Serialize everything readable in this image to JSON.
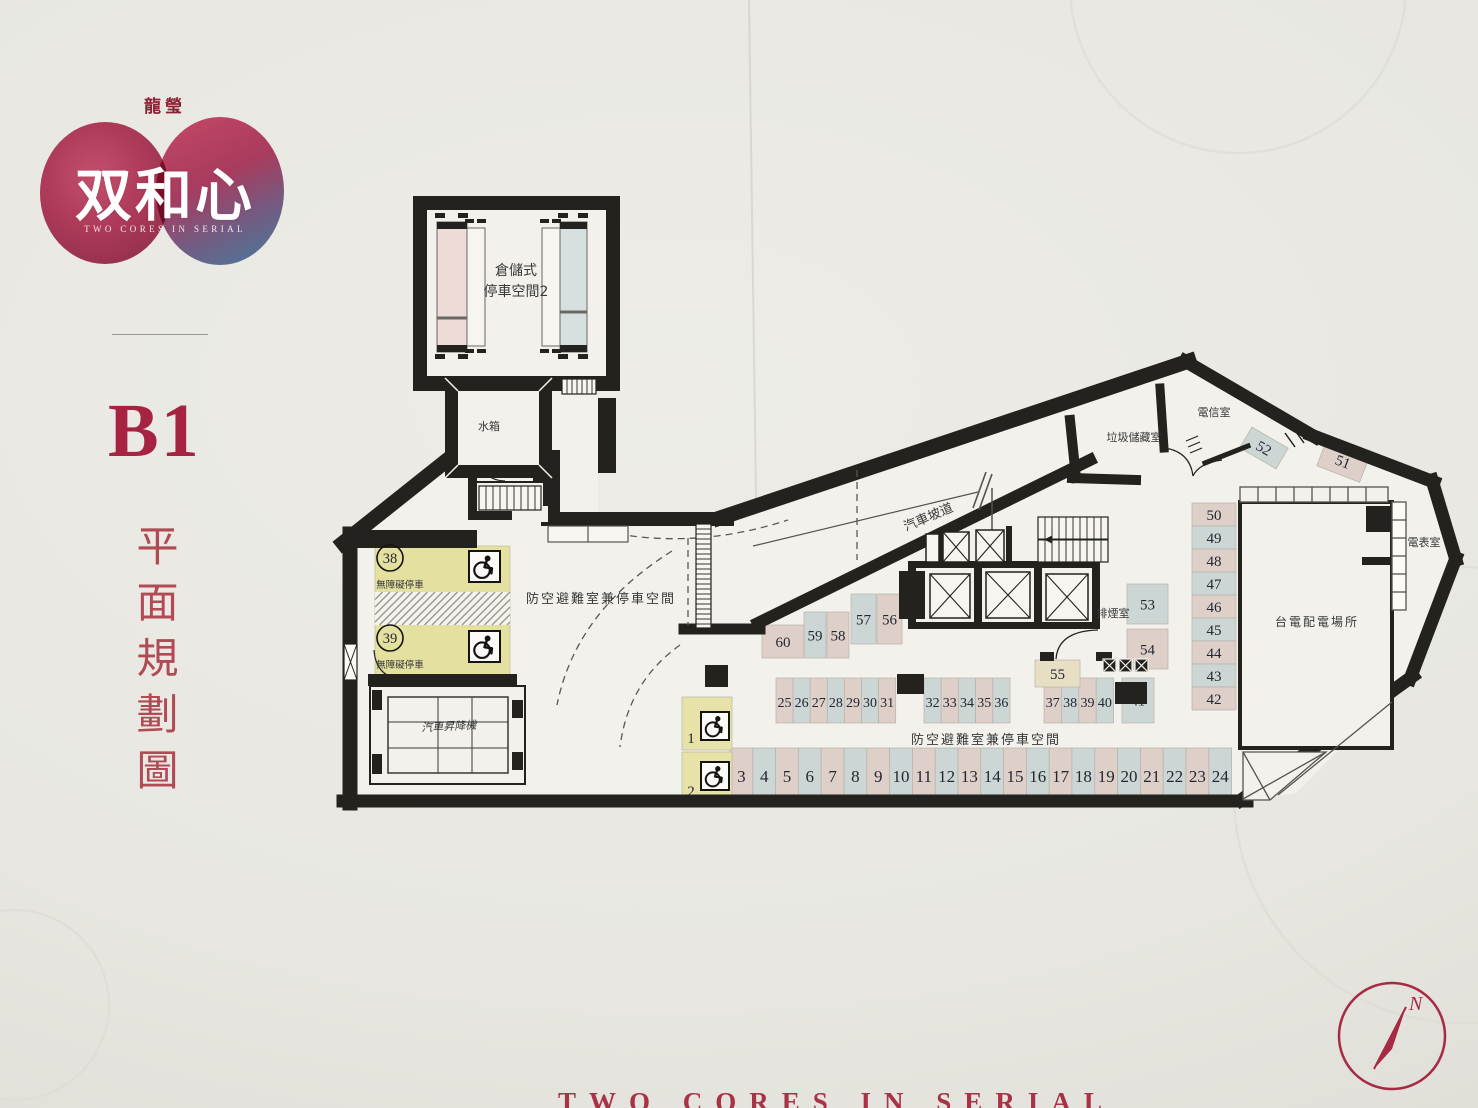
{
  "logo": {
    "company": "龍瑩",
    "name": "双和心",
    "tagline": "TWO CORES IN SERIAL"
  },
  "floor": {
    "code": "B1",
    "title": "平面規劃圖"
  },
  "footer": {
    "tagline": "TWO CORES IN SERIAL"
  },
  "compass": {
    "north": "N"
  },
  "colors": {
    "pink": "#decfc9",
    "blue": "#ccd6d5",
    "yellow": "#e7e3a8",
    "cream": "#e6dfc4",
    "zoneYellow": "#e4e0a0",
    "wall": "#23221f",
    "floor": "#f2f1eb",
    "num": "#232732",
    "label": "#38383a",
    "red": "#a62a44"
  },
  "labels": [
    {
      "id": "storage-room-line1",
      "text": "倉儲式",
      "x": 516,
      "y": 275,
      "s": 14
    },
    {
      "id": "storage-room-line2",
      "text": "停車空間2",
      "x": 516,
      "y": 296,
      "s": 14
    },
    {
      "id": "water-tank-room",
      "text": "水箱",
      "x": 489,
      "y": 430,
      "s": 11
    },
    {
      "id": "car-ramp",
      "text": "汽車坡道",
      "x": 930,
      "y": 521,
      "s": 13,
      "rot": -23
    },
    {
      "id": "garbage-storage-room",
      "text": "垃圾儲藏室",
      "x": 1134,
      "y": 441,
      "s": 11
    },
    {
      "id": "telecom-room",
      "text": "電信室",
      "x": 1214,
      "y": 416,
      "s": 11
    },
    {
      "id": "shelter-parking-left",
      "text": "防空避難室兼停車空間",
      "x": 601,
      "y": 603,
      "s": 13,
      "ls": 2
    },
    {
      "id": "shelter-parking-bottom",
      "text": "防空避難室兼停車空間",
      "x": 986,
      "y": 744,
      "s": 13,
      "ls": 2
    },
    {
      "id": "car-lift-room",
      "text": "汽車昇降機",
      "x": 449,
      "y": 730,
      "s": 11,
      "rot": -3,
      "italic": true
    },
    {
      "id": "smoke-exhaust-room",
      "text": "排煙室",
      "x": 1113,
      "y": 617,
      "s": 11
    },
    {
      "id": "taipower-distribution-room",
      "text": "台電配電場所",
      "x": 1317,
      "y": 626,
      "s": 12,
      "ls": 2
    },
    {
      "id": "meter-room",
      "text": "電表室",
      "x": 1424,
      "y": 546,
      "s": 11
    },
    {
      "id": "accessible-parking-label-1",
      "text": "無障礙停車",
      "x": 400,
      "y": 588,
      "s": 9.5
    },
    {
      "id": "accessible-parking-label-2",
      "text": "無障礙停車",
      "x": 400,
      "y": 668,
      "s": 9.5
    }
  ],
  "parking": {
    "rows": [
      {
        "name": "bottom-row",
        "from": 3,
        "to": 24,
        "x0": 730,
        "w": 22.8,
        "y": 748,
        "h": 57,
        "numY": 782,
        "fs": 17,
        "oddPink": true
      },
      {
        "name": "mid-row-1",
        "from": 25,
        "to": 31,
        "x0": 776,
        "w": 17.1,
        "y": 678,
        "h": 45,
        "numY": 707,
        "fs": 14,
        "oddPink": true
      },
      {
        "name": "mid-row-2",
        "from": 32,
        "to": 36,
        "x0": 924,
        "w": 17.2,
        "y": 678,
        "h": 45,
        "numY": 707,
        "fs": 14,
        "oddPink": true
      },
      {
        "name": "mid-row-3",
        "from": 37,
        "to": 40,
        "x0": 1044,
        "w": 17.4,
        "y": 678,
        "h": 45,
        "numY": 707,
        "fs": 14,
        "oddPink": true
      }
    ],
    "column": {
      "name": "right-column",
      "from": 42,
      "to": 50,
      "x": 1192,
      "w": 44,
      "yTop": 503,
      "hEach": 23,
      "fs": 15,
      "evenPink": true
    },
    "singles": [
      {
        "n": "41",
        "x": 1122,
        "y": 678,
        "w": 32,
        "h": 45,
        "c": "blue",
        "fs": 14
      },
      {
        "n": "51",
        "x": 1320,
        "y": 448,
        "w": 46,
        "h": 27,
        "c": "pink",
        "fs": 15,
        "rot": 21
      },
      {
        "n": "52",
        "x": 1243,
        "y": 436,
        "w": 42,
        "h": 24,
        "c": "blue",
        "fs": 15,
        "rot": 30
      },
      {
        "n": "53",
        "x": 1127,
        "y": 584,
        "w": 41,
        "h": 40,
        "c": "blue",
        "fs": 15
      },
      {
        "n": "54",
        "x": 1127,
        "y": 629,
        "w": 41,
        "h": 40,
        "c": "pink",
        "fs": 15
      },
      {
        "n": "55",
        "x": 1035,
        "y": 660,
        "w": 45,
        "h": 27,
        "c": "cream",
        "fs": 15
      },
      {
        "n": "56",
        "x": 877,
        "y": 594,
        "w": 25,
        "h": 50,
        "c": "pink",
        "fs": 15
      },
      {
        "n": "57",
        "x": 851,
        "y": 594,
        "w": 25,
        "h": 50,
        "c": "blue",
        "fs": 15
      },
      {
        "n": "58",
        "x": 827,
        "y": 612,
        "w": 22,
        "h": 46,
        "c": "pink",
        "fs": 15
      },
      {
        "n": "59",
        "x": 804,
        "y": 612,
        "w": 22,
        "h": 46,
        "c": "blue",
        "fs": 15
      },
      {
        "n": "60",
        "x": 762,
        "y": 625,
        "w": 42,
        "h": 33,
        "c": "pink",
        "fs": 15
      },
      {
        "n": "1",
        "x": 682,
        "y": 697,
        "w": 50,
        "h": 53,
        "c": "yellow",
        "fs": 15,
        "numX": 691,
        "numY": 743
      },
      {
        "n": "2",
        "x": 682,
        "y": 752,
        "w": 50,
        "h": 53,
        "c": "yellow",
        "fs": 15,
        "numX": 691,
        "numY": 796
      }
    ],
    "circled": [
      {
        "n": "38",
        "cx": 390,
        "cy": 558
      },
      {
        "n": "39",
        "cx": 390,
        "cy": 638
      }
    ],
    "wheelchairs": [
      {
        "x": 469,
        "y": 551,
        "s": 31
      },
      {
        "x": 469,
        "y": 631,
        "s": 31
      },
      {
        "x": 701,
        "y": 712,
        "s": 28
      },
      {
        "x": 701,
        "y": 762,
        "s": 28
      }
    ],
    "stairs": [
      {
        "id": "stair-upper",
        "x": 562,
        "y": 379,
        "w": 34,
        "h": 15,
        "step": 5
      },
      {
        "id": "stair-corridor",
        "x": 479,
        "y": 486,
        "w": 62,
        "h": 24,
        "step": 7
      },
      {
        "id": "stair-core",
        "x": 1038,
        "y": 517,
        "w": 70,
        "h": 45,
        "step": 7,
        "mid": true
      },
      {
        "id": "ramp-edge-ladder",
        "x": 696,
        "y": 524,
        "w": 15,
        "h": 104,
        "step": 5,
        "horiz": true
      }
    ]
  }
}
